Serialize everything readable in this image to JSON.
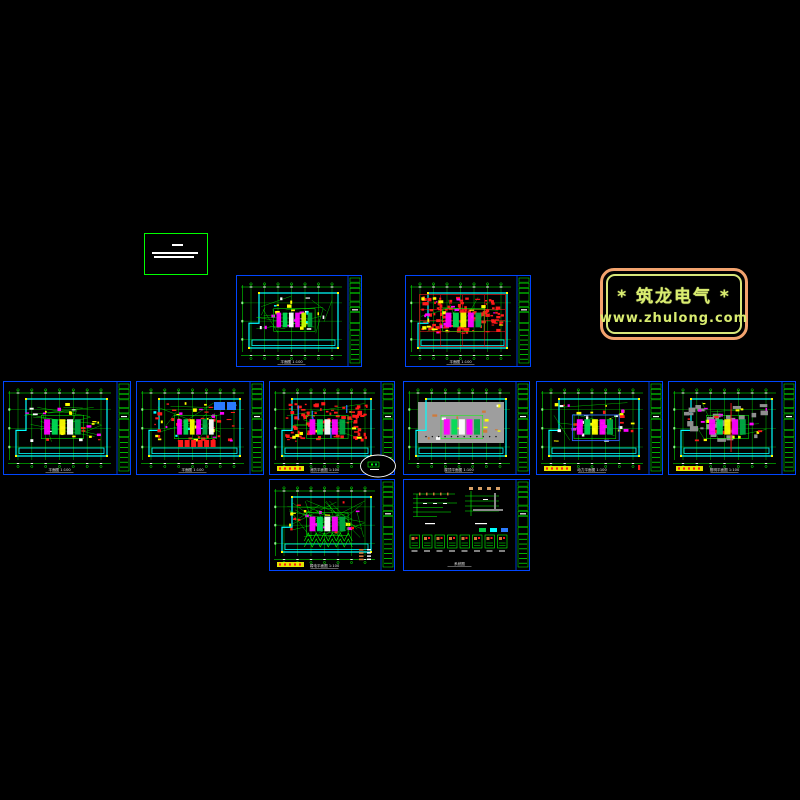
{
  "canvas": {
    "w": 800,
    "h": 800,
    "bg": "#000000"
  },
  "colors": {
    "bg": "#000000",
    "sheet_border": "#0046ff",
    "grid_green": "#00ff00",
    "outline_cyan": "#00ffff",
    "tick_white": "#ffffff",
    "red": "#ff1a1a",
    "magenta": "#ff00ff",
    "yellow": "#ffff00",
    "gray_fill": "#9e9e9e",
    "gray_block": "#8f8f8f",
    "orange": "#cf7a3a",
    "blue_fill": "#2b7bff",
    "label_yellow": "#ffff00"
  },
  "note_box": {
    "x": 144,
    "y": 233,
    "w": 62,
    "h": 40,
    "lines": [
      {
        "x": 27,
        "y": 10,
        "w": 11,
        "h": 2
      },
      {
        "x": 7,
        "y": 18,
        "w": 46,
        "h": 2
      },
      {
        "x": 9,
        "y": 22,
        "w": 40,
        "h": 1.5
      }
    ]
  },
  "logo": {
    "x": 600,
    "y": 268,
    "w": 148,
    "h": 72,
    "line1": "*  筑龙电气  *",
    "line2": "www.zhulong.com",
    "outer_color": "#f2a36e",
    "inner_color": "#d8e87a",
    "text_color": "#d9ec70"
  },
  "sheets": [
    {
      "id": "plan-1f-a",
      "x": 236,
      "y": 275,
      "w": 126,
      "h": 92,
      "kind": "plan",
      "title": "平面图 1:100",
      "web": {
        "n": 14,
        "seed": 2,
        "c": "#00ff00"
      },
      "scatter": [
        {
          "c": "#ff00ff",
          "n": 6,
          "seed": 3
        },
        {
          "c": "#ffff00",
          "n": 8,
          "seed": 4
        },
        {
          "c": "#ffffff",
          "n": 6,
          "seed": 5
        },
        {
          "c": "#00ffff",
          "n": 3,
          "seed": 6
        }
      ],
      "cluster": [
        "#ff00ff",
        "#00dd55",
        "#ffffff",
        "#ff00ff",
        "#ccff00",
        "#00aa44"
      ],
      "flags": []
    },
    {
      "id": "plan-1f-b",
      "x": 405,
      "y": 275,
      "w": 126,
      "h": 92,
      "kind": "plan",
      "title": "平面图 1:100",
      "web": {
        "n": 8,
        "seed": 7,
        "c": "#00ff00"
      },
      "scatter": [
        {
          "c": "#ff1a1a",
          "n": 110,
          "seed": 8
        },
        {
          "c": "#ffff00",
          "n": 14,
          "seed": 9
        },
        {
          "c": "#ff00ff",
          "n": 10,
          "seed": 10
        }
      ],
      "cluster": [
        "#ff00ff",
        "#00dd55",
        "#ffff00",
        "#ff00ff",
        "#00aa44"
      ],
      "flags": [
        "redbands"
      ]
    },
    {
      "id": "plan-2f-a",
      "x": 3,
      "y": 381,
      "w": 128,
      "h": 94,
      "kind": "plan",
      "title": "平面图 1:100",
      "web": {
        "n": 12,
        "seed": 11,
        "c": "#00ff00"
      },
      "scatter": [
        {
          "c": "#ffff00",
          "n": 10,
          "seed": 12
        },
        {
          "c": "#ff00ff",
          "n": 6,
          "seed": 13
        },
        {
          "c": "#ffffff",
          "n": 6,
          "seed": 14
        },
        {
          "c": "#ff1a1a",
          "n": 4,
          "seed": 15
        }
      ],
      "cluster": [
        "#ff00ff",
        "#00dd55",
        "#ffff00",
        "#ffffff",
        "#00aa44"
      ],
      "flags": []
    },
    {
      "id": "plan-2f-b",
      "x": 136,
      "y": 381,
      "w": 128,
      "h": 94,
      "kind": "plan",
      "title": "平面图 1:100",
      "web": {
        "n": 10,
        "seed": 16,
        "c": "#00ff00"
      },
      "scatter": [
        {
          "c": "#ff1a1a",
          "n": 30,
          "seed": 17
        },
        {
          "c": "#ffff00",
          "n": 14,
          "seed": 18
        },
        {
          "c": "#ff00ff",
          "n": 8,
          "seed": 19
        },
        {
          "c": "#00ffff",
          "n": 6,
          "seed": 20
        }
      ],
      "cluster": [
        "#ff00ff",
        "#00dd55",
        "#ffff00",
        "#ff00ff",
        "#00aa44",
        "#ffffff"
      ],
      "flags": [
        "bluerects",
        "redrow"
      ]
    },
    {
      "id": "plan-fire",
      "x": 269,
      "y": 381,
      "w": 126,
      "h": 94,
      "kind": "plan",
      "title": "消防平面图 1:100",
      "web": {
        "n": 6,
        "seed": 21,
        "c": "#00ff00"
      },
      "scatter": [
        {
          "c": "#ff1a1a",
          "n": 100,
          "seed": 22
        },
        {
          "c": "#ffff00",
          "n": 8,
          "seed": 23
        },
        {
          "c": "#2b7bff",
          "n": 5,
          "seed": 24,
          "tall": true
        }
      ],
      "cluster": [
        "#ff00ff",
        "#00dd55",
        "#ffffff",
        "#ff00ff",
        "#00aa44"
      ],
      "flags": [
        "yellow-label",
        "bubble"
      ]
    },
    {
      "id": "plan-roof",
      "x": 403,
      "y": 381,
      "w": 127,
      "h": 94,
      "kind": "plan",
      "title": "屋顶平面图 1:100",
      "web": {
        "n": 0,
        "seed": 25,
        "c": "#00ff00"
      },
      "scatter": [
        {
          "c": "#cf7a3a",
          "n": 6,
          "seed": 26
        },
        {
          "c": "#ffff00",
          "n": 6,
          "seed": 27
        },
        {
          "c": "#ffffff",
          "n": 4,
          "seed": 28
        }
      ],
      "cluster": [
        "#ff00ff",
        "#00dd55",
        "#ffffff",
        "#ff00ff",
        "#00aa44"
      ],
      "flags": [
        "grayfill",
        "dotrow"
      ]
    },
    {
      "id": "plan-power",
      "x": 536,
      "y": 381,
      "w": 127,
      "h": 94,
      "kind": "plan",
      "title": "动力平面图 1:100",
      "web": {
        "n": 6,
        "seed": 29,
        "c": "#00ff00"
      },
      "scatter": [
        {
          "c": "#ffff00",
          "n": 20,
          "seed": 30
        },
        {
          "c": "#ffffff",
          "n": 10,
          "seed": 31
        },
        {
          "c": "#ff1a1a",
          "n": 8,
          "seed": 32
        },
        {
          "c": "#ff00ff",
          "n": 6,
          "seed": 33
        }
      ],
      "cluster": [
        "#ff00ff",
        "#00dd55",
        "#ffff00",
        "#ff00ff",
        "#00aa44"
      ],
      "flags": [
        "bluebox",
        "yellow-label",
        "redmark"
      ]
    },
    {
      "id": "plan-light",
      "x": 668,
      "y": 381,
      "w": 128,
      "h": 94,
      "kind": "plan",
      "title": "照明平面图 1:100",
      "web": {
        "n": 6,
        "seed": 34,
        "c": "#00ff00"
      },
      "scatter": [
        {
          "c": "#8f8f8f",
          "n": 30,
          "seed": 35,
          "big": true
        },
        {
          "c": "#ffff00",
          "n": 10,
          "seed": 36
        },
        {
          "c": "#ff00ff",
          "n": 6,
          "seed": 37
        },
        {
          "c": "#ff1a1a",
          "n": 6,
          "seed": 38
        }
      ],
      "cluster": [
        "#ff00ff",
        "#00dd55",
        "#ffff00",
        "#ff00ff",
        "#00aa44"
      ],
      "flags": [
        "redline",
        "yellow-label"
      ]
    },
    {
      "id": "plan-weak",
      "x": 269,
      "y": 479,
      "w": 126,
      "h": 92,
      "kind": "plan",
      "title": "弱电平面图 1:100",
      "web": {
        "n": 26,
        "seed": 39,
        "c": "#00ff00"
      },
      "scatter": [
        {
          "c": "#ff00ff",
          "n": 8,
          "seed": 40
        },
        {
          "c": "#ff1a1a",
          "n": 8,
          "seed": 41
        },
        {
          "c": "#ffff00",
          "n": 6,
          "seed": 42
        }
      ],
      "cluster": [
        "#ff00ff",
        "#00dd55",
        "#ffffff",
        "#ff00ff",
        "#00aa44"
      ],
      "flags": [
        "zigzag",
        "yellow-label",
        "stacks"
      ]
    },
    {
      "id": "system-diagram",
      "x": 403,
      "y": 479,
      "w": 127,
      "h": 92,
      "kind": "diagram",
      "title": "系统图",
      "riser_color": "#00ff00",
      "block_colors": [
        "#00cc44",
        "#00ffff",
        "#2b7bff"
      ],
      "legend_count": 8,
      "flags": []
    }
  ]
}
